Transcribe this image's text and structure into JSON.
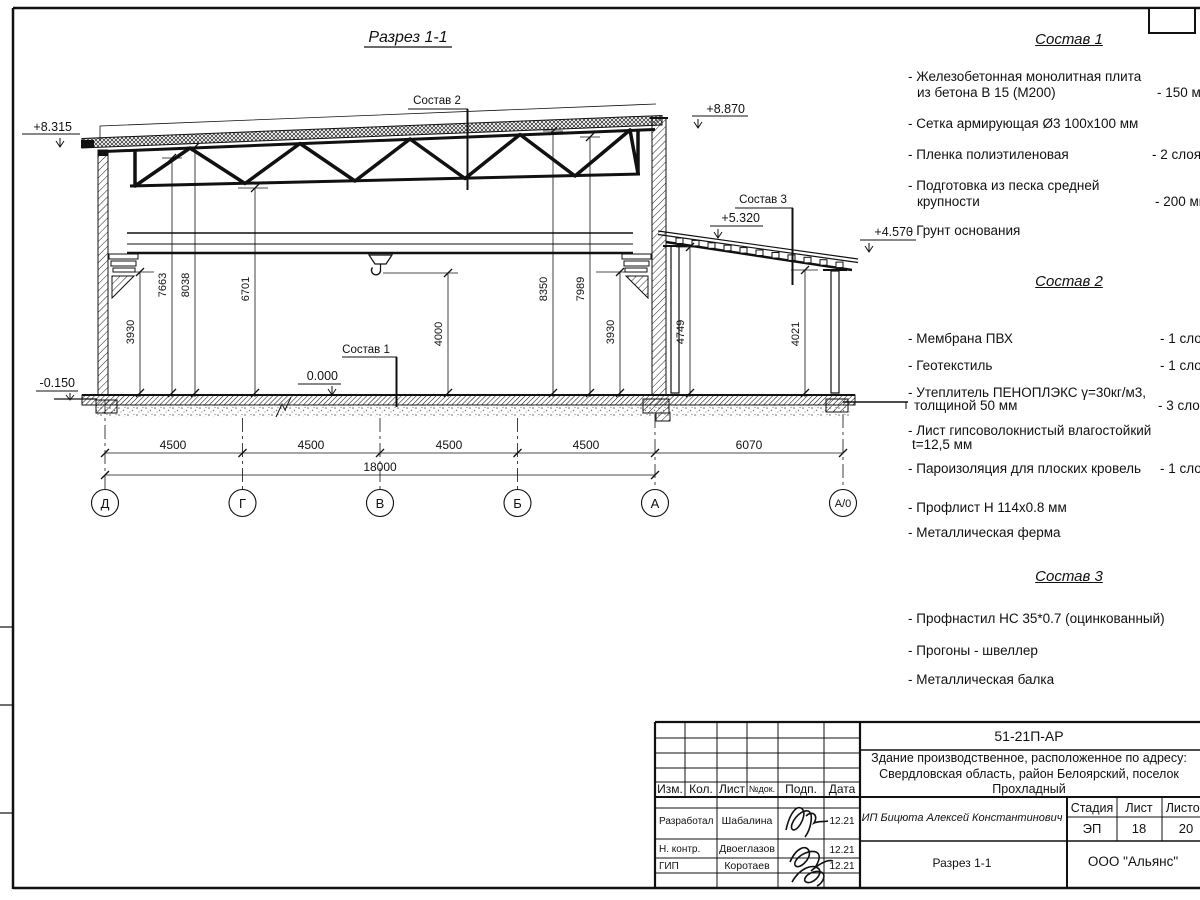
{
  "sheet_title": "Разрез 1-1",
  "drawing": {
    "callouts": {
      "c1": "Состав 1",
      "c2": "Состав 2",
      "c3": "Состав 3"
    },
    "elevations": {
      "roof_left": "+8.315",
      "roof_right": "+8.870",
      "annex_high": "+5.320",
      "annex_low": "+4.570",
      "floor": "0.000",
      "ground": "-0.150"
    },
    "vdims": [
      "3930",
      "7663",
      "8038",
      "6701",
      "4000",
      "8350",
      "7989",
      "3930",
      "4749",
      "4021"
    ],
    "hdims": [
      "4500",
      "4500",
      "4500",
      "4500",
      "6070"
    ],
    "total_dim": "18000",
    "axes": [
      "Д",
      "Г",
      "В",
      "Б",
      "А",
      "А/0"
    ]
  },
  "lists": {
    "s1": {
      "title": "Состав 1",
      "items": [
        {
          "l1": "- Железобетонная  монолитная плита",
          "l2": "из бетона В 15 (М200)",
          "v": "- 150 мм"
        },
        {
          "l1": "- Сетка армирующая Ø3 100х100 мм",
          "l2": "",
          "v": ""
        },
        {
          "l1": "- Пленка полиэтиленовая",
          "l2": "",
          "v": "-  2 слоя"
        },
        {
          "l1": "- Подготовка из песка средней",
          "l2": "крупности",
          "v": "- 200 мм"
        },
        {
          "l1": "- Грунт основания",
          "l2": "",
          "v": ""
        }
      ]
    },
    "s2": {
      "title": "Состав 2",
      "items": [
        {
          "l1": "- Мембрана ПВХ",
          "l2": "",
          "v": "- 1 слой"
        },
        {
          "l1": "- Геотекстиль",
          "l2": "",
          "v": "- 1 слой"
        },
        {
          "l1": "- Утеплитель ПЕНОПЛЭКС γ=30кг/м3,",
          "l2": "толщиной 50 мм",
          "v": "- 3 слоя"
        },
        {
          "l1": "- Лист гипсоволокнистый влагостойкий",
          "l2": "t=12,5 мм",
          "v": ""
        },
        {
          "l1": "- Пароизоляция для плоских кровель",
          "l2": "",
          "v": "- 1 слой"
        },
        {
          "l1": "- Профлист Н 114х0.8 мм",
          "l2": "",
          "v": ""
        },
        {
          "l1": "- Металлическая ферма",
          "l2": "",
          "v": ""
        }
      ]
    },
    "s3": {
      "title": "Состав 3",
      "items": [
        {
          "l1": "- Профнастил НС 35*0.7 (оцинкованный)"
        },
        {
          "l1": "- Прогоны - швеллер"
        },
        {
          "l1": "- Металлическая балка"
        }
      ]
    }
  },
  "titleblock": {
    "doc_number": "51-21П-АР",
    "project_line1": "Здание производственное, расположенное по адресу:",
    "project_line2": "Свердловская область, район Белоярский, поселок",
    "project_line3": "Прохладный",
    "client": "ИП Бицюта Алексей Константинович",
    "sheet_name": "Разрез 1-1",
    "company": "ООО \"Альянс\"",
    "headers": {
      "izm": "Изм.",
      "kol": "Кол.",
      "list": "Лист",
      "ndok": "№док.",
      "podp": "Подп.",
      "data": "Дата",
      "stadia": "Стадия",
      "list2": "Лист",
      "listov": "Листов"
    },
    "stadia_value": "ЭП",
    "list_value": "18",
    "listov_value": "20",
    "rows": [
      {
        "role": "Разработал",
        "name": "Шабалина",
        "date": "12.21"
      },
      {
        "role": "Н. контр.",
        "name": "Двоеглазов",
        "date": "12.21"
      },
      {
        "role": "ГИП",
        "name": "Коротаев",
        "date": "12.21"
      }
    ]
  }
}
